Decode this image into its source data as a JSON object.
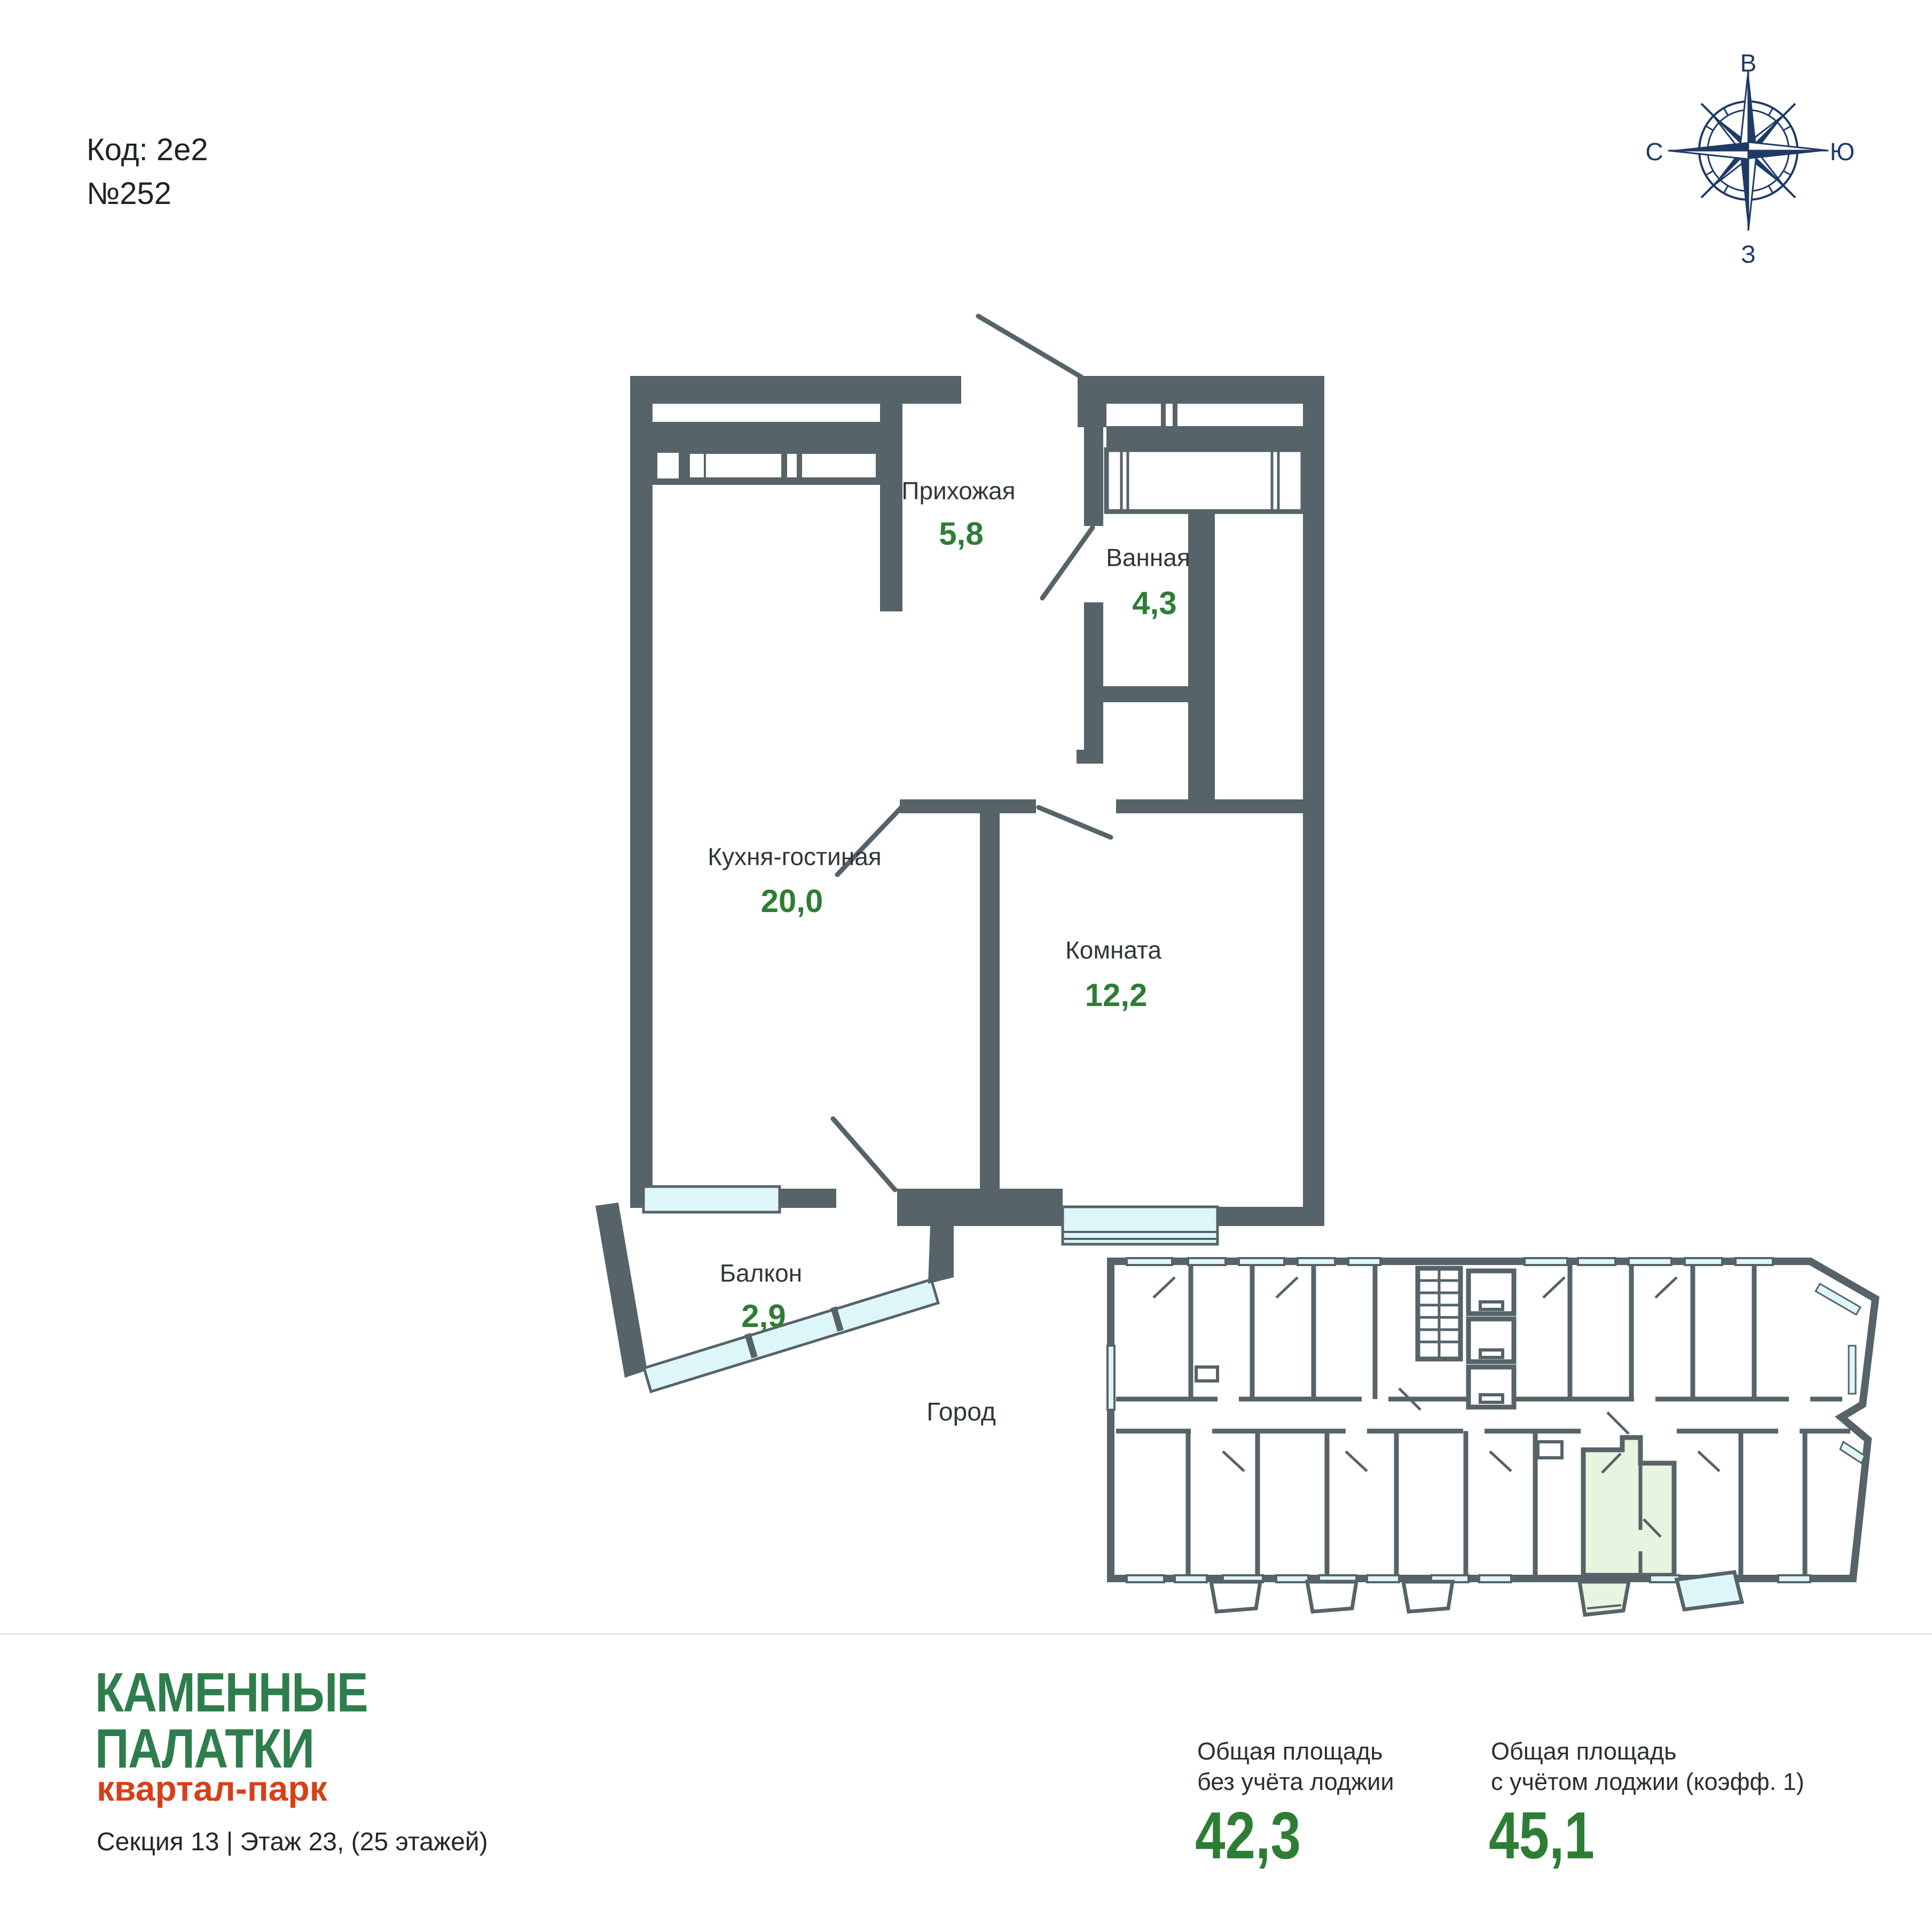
{
  "header": {
    "code_label": "Код: 2е2",
    "number_label": "№252"
  },
  "compass": {
    "top": "В",
    "right": "Ю",
    "bottom": "З",
    "left": "С"
  },
  "plan": {
    "rooms": [
      {
        "name": "Прихожая",
        "area": "5,8"
      },
      {
        "name": "Ванная",
        "area": "4,3"
      },
      {
        "name": "Кухня-гостиная",
        "area": "20,0"
      },
      {
        "name": "Комната",
        "area": "12,2"
      },
      {
        "name": "Балкон",
        "area": "2,9"
      }
    ],
    "outside_label": "Город"
  },
  "footer": {
    "brand_line1": "КАМЕННЫЕ",
    "brand_line2": "ПАЛАТКИ",
    "brand_sub": "квартал-парк",
    "section_info": "Секция 13 | Этаж 23, (25 этажей)",
    "stats": [
      {
        "label_line1": "Общая площадь",
        "label_line2": "без учёта лоджии",
        "value": "42,3"
      },
      {
        "label_line1": "Общая площадь",
        "label_line2": "с учётом лоджии (коэфф. 1)",
        "value": "45,1"
      }
    ]
  },
  "colors": {
    "wall": "#566368",
    "window": "#ddf6fa",
    "area_green": "#2e7d35",
    "brand_green": "#2e7d4c",
    "brand_orange": "#d64018",
    "compass_navy": "#1e3a66",
    "highlight_unit": "#e9f4e0"
  }
}
